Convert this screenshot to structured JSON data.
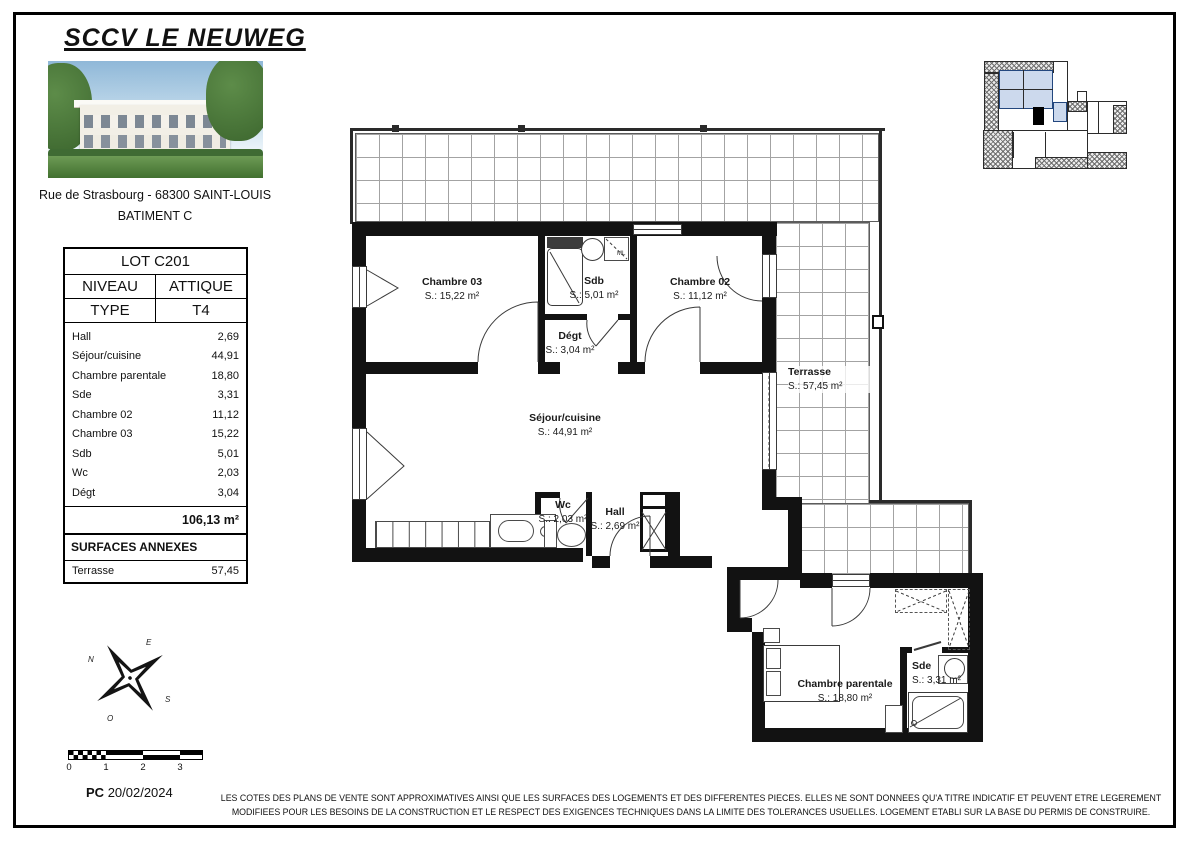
{
  "header": {
    "title": "SCCV LE NEUWEG",
    "address": "Rue de Strasbourg - 68300 SAINT-LOUIS",
    "building": "BATIMENT C"
  },
  "lot_table": {
    "lot": "LOT C201",
    "niveau_label": "NIVEAU",
    "niveau_value": "ATTIQUE",
    "type_label": "TYPE",
    "type_value": "T4",
    "rooms": [
      {
        "name": "Hall",
        "area": "2,69"
      },
      {
        "name": "Séjour/cuisine",
        "area": "44,91"
      },
      {
        "name": "Chambre parentale",
        "area": "18,80"
      },
      {
        "name": "Sde",
        "area": "3,31"
      },
      {
        "name": "Chambre 02",
        "area": "11,12"
      },
      {
        "name": "Chambre 03",
        "area": "15,22"
      },
      {
        "name": "Sdb",
        "area": "5,01"
      },
      {
        "name": "Wc",
        "area": "2,03"
      },
      {
        "name": "Dégt",
        "area": "3,04"
      }
    ],
    "total": "106,13 m²",
    "annexes_title": "SURFACES ANNEXES",
    "annexes_name": "Terrasse",
    "annexes_area": "57,45"
  },
  "plan": {
    "rooms": [
      {
        "name": "Chambre 03",
        "area": "S.: 15,22 m²"
      },
      {
        "name": "Sdb",
        "area": "S.: 5,01 m²"
      },
      {
        "name": "Chambre 02",
        "area": "S.: 11,12 m²"
      },
      {
        "name": "Dégt",
        "area": "S.: 3,04 m²"
      },
      {
        "name": "Séjour/cuisine",
        "area": "S.: 44,91 m²"
      },
      {
        "name": "Wc",
        "area": "S.: 2,03 m²"
      },
      {
        "name": "Hall",
        "area": "S.: 2,69 m²"
      },
      {
        "name": "Terrasse",
        "area": "S.: 57,45 m²"
      },
      {
        "name": "Chambre parentale",
        "area": "S.: 18,80 m²"
      },
      {
        "name": "Sde",
        "area": "S.: 3,31 m²"
      }
    ],
    "ml_label": "ML"
  },
  "compass": {
    "n": "N",
    "e": "E",
    "s": "S",
    "o": "O"
  },
  "scalebar": {
    "ticks": [
      "0",
      "1",
      "2",
      "3"
    ]
  },
  "footer": {
    "pc_label": "PC",
    "date": "20/02/2024",
    "disclaimer_line1": "LES COTES DES PLANS DE VENTE SONT APPROXIMATIVES AINSI QUE LES SURFACES DES LOGEMENTS ET DES DIFFERENTES PIECES. ELLES NE SONT DONNEES QU'A TITRE INDICATIF ET PEUVENT ETRE LEGEREMENT",
    "disclaimer_line2": "MODIFIEES POUR LES BESOINS DE LA CONSTRUCTION ET LE RESPECT DES EXIGENCES TECHNIQUES DANS LA LIMITE DES TOLERANCES USUELLES. LOGEMENT ETABLI SUR LA BASE DU PERMIS DE CONSTRUIRE."
  }
}
